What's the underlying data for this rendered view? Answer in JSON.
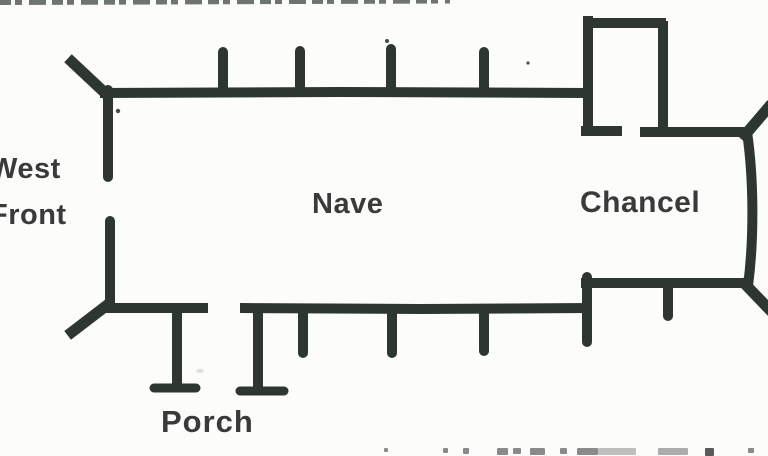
{
  "colors": {
    "bg": "#fcfcfb",
    "line": "#2d372f",
    "text": "#3a3a3a",
    "speck": "#4a4a4a",
    "cropped_top": "#3f463f",
    "cropped_bottom": "#8a8a8a"
  },
  "diagram": {
    "type": "church-floor-plan",
    "labels": {
      "west_front_line1": "West",
      "west_front_line2": "Front",
      "nave": "Nave",
      "chancel": "Chancel",
      "porch": "Porch"
    }
  }
}
